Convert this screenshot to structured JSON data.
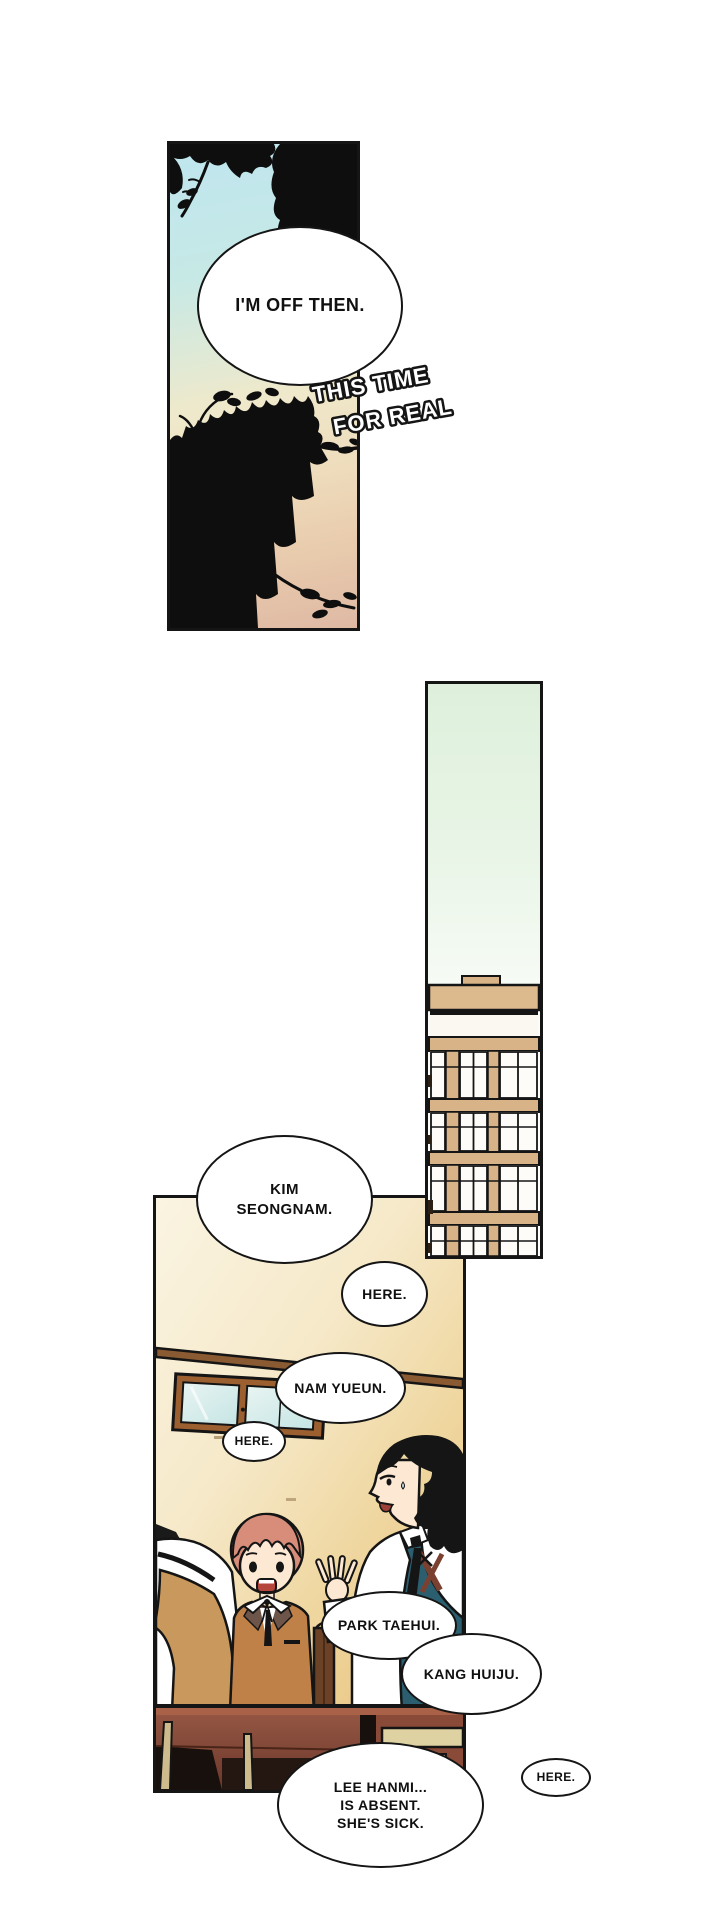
{
  "colors": {
    "panel_border": "#151515",
    "sky_top": "#bfe5ef",
    "sky_warm": "#dfb8a4",
    "building_sky": "#def0dc",
    "building_tan": "#dcba8e",
    "wall_cream": "#faf4e2",
    "wall_amber": "#e9c27c",
    "hair_red": "#d78d7a",
    "hair_black": "#151515",
    "vest_teal": "#2b5f70",
    "vest_tan": "#c9985c",
    "blazer_brown": "#c08148",
    "desk_brown": "#6b372b",
    "glass_blue": "#cfe9ec",
    "bubble_bg": "#ffffff"
  },
  "sky_panel": {
    "bubble_im_off": "I'M OFF THEN.",
    "sfx_line1": "THIS TIME",
    "sfx_line2": "FOR REAL"
  },
  "classroom": {
    "bubble_kim_line1": "KIM",
    "bubble_kim_line2": "SEONGNAM.",
    "bubble_here_1": "HERE.",
    "bubble_nam": "NAM YUEUN.",
    "bubble_here_2": "HERE.",
    "bubble_park": "PARK TAEHUI.",
    "bubble_kang": "KANG HUIJU.",
    "bubble_lee_line1": "LEE HANMI...",
    "bubble_lee_line2": "IS ABSENT.",
    "bubble_lee_line3": "SHE'S SICK.",
    "bubble_here_3": "HERE."
  }
}
